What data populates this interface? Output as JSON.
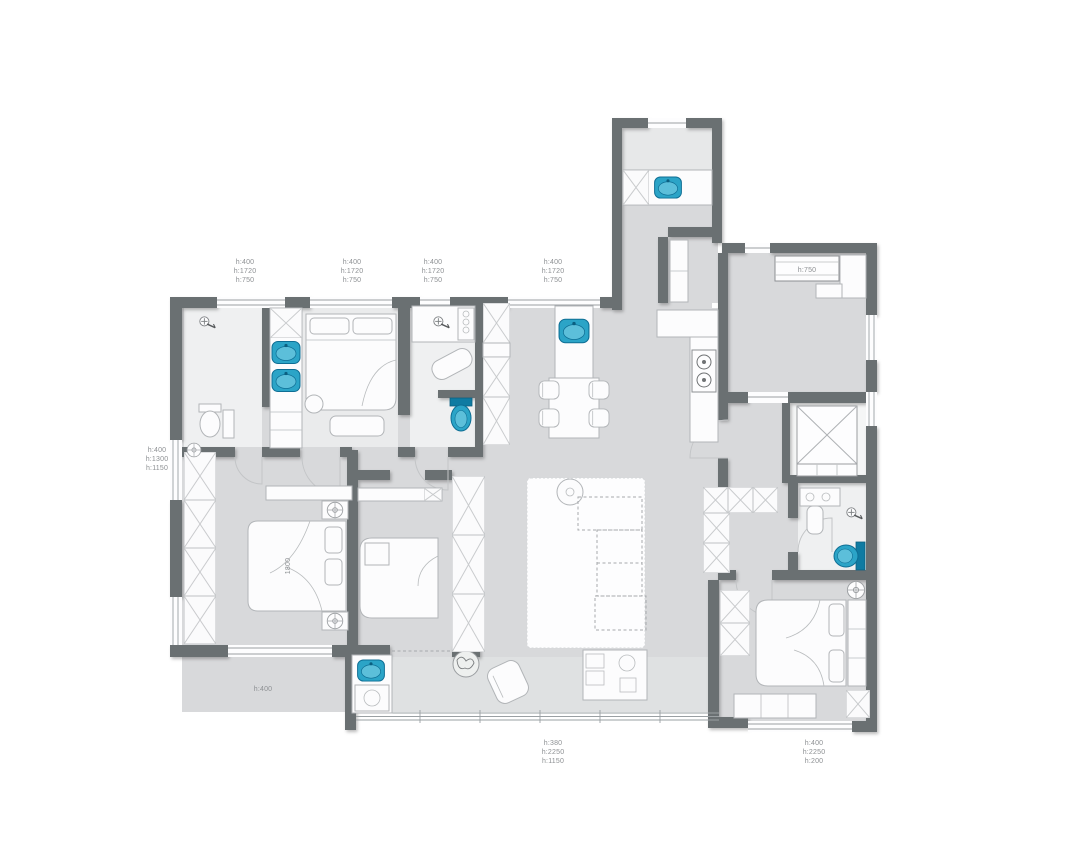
{
  "plan": {
    "labels": {
      "w1": [
        "h:400",
        "h:1720",
        "h:750"
      ],
      "w2": [
        "h:400",
        "h:1720",
        "h:750"
      ],
      "w3": [
        "h:400",
        "h:1720",
        "h:750"
      ],
      "w4": [
        "h:400",
        "h:1720",
        "h:750"
      ],
      "left_window": [
        "h:400",
        "h:1300",
        "h:1150"
      ],
      "bottom_left_window": [
        "h:400"
      ],
      "balcony_window": [
        "h:380",
        "h:2250",
        "h:1150"
      ],
      "bedroom3_window": [
        "h:400",
        "h:2250",
        "h:200"
      ],
      "kitchen_window": [
        "h:750"
      ],
      "bed_width": "1800"
    },
    "colors": {
      "wall": "#6b6f72",
      "floor": "#d8d9db",
      "floor_bath": "#eff0f1",
      "floor_balcony": "#dfe1e2",
      "fixture_teal": "#2ba4c7",
      "fixture_teal_dark": "#0e6e94",
      "furniture_stroke": "#b2b5b8",
      "label_text": "#8d9093",
      "background": "#ffffff"
    },
    "icons": [
      "sink-icon",
      "toilet-icon",
      "shower-icon",
      "stove-icon",
      "elevator-icon",
      "plant-icon",
      "wardrobe-x-icon",
      "compass-icon",
      "washer-icon",
      "chair-icon"
    ]
  }
}
